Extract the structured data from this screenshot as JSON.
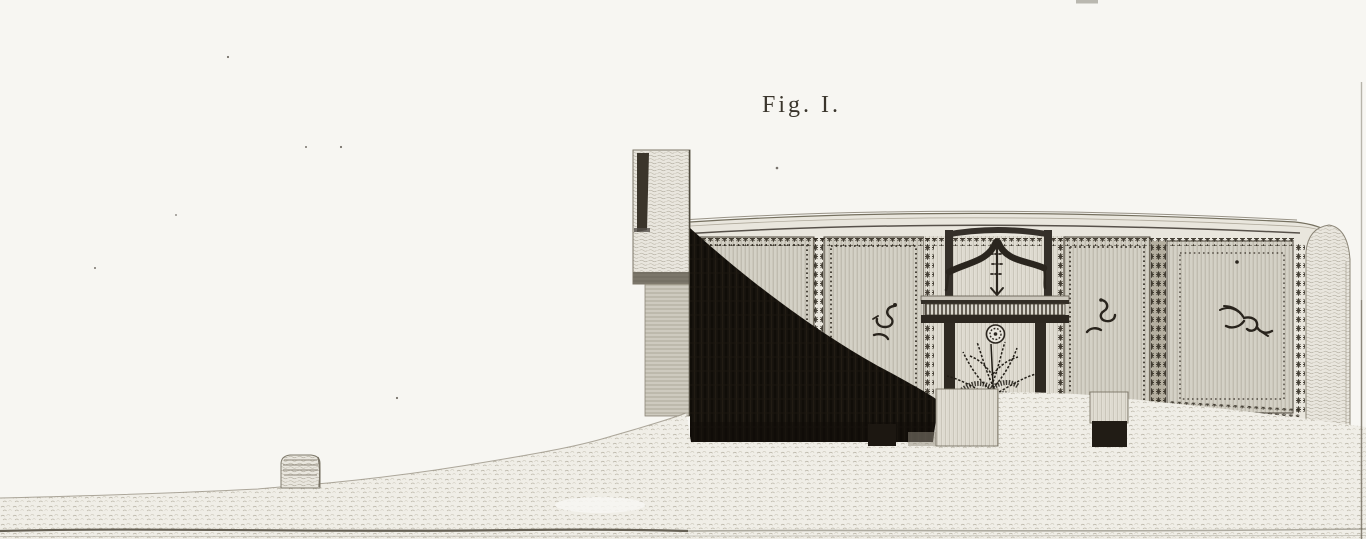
{
  "plate": {
    "caption": "Fig. I.",
    "artwork_kind": "engraved architectural section plate",
    "motifs": [
      "sea-horse",
      "sea-serpent",
      "winged-sea-griffin"
    ],
    "ornaments": [
      "drapery-swag",
      "rosette-medallion",
      "garland-borders",
      "dentil-course",
      "shrub-in-doorway",
      "shadow-cast-by-pier"
    ]
  },
  "colors": {
    "paper": "#f7f6f2",
    "panel_wash": "#dcd9cf",
    "ink": "#26221b",
    "shadow": "#16120d",
    "ground": "#f0eee7"
  }
}
